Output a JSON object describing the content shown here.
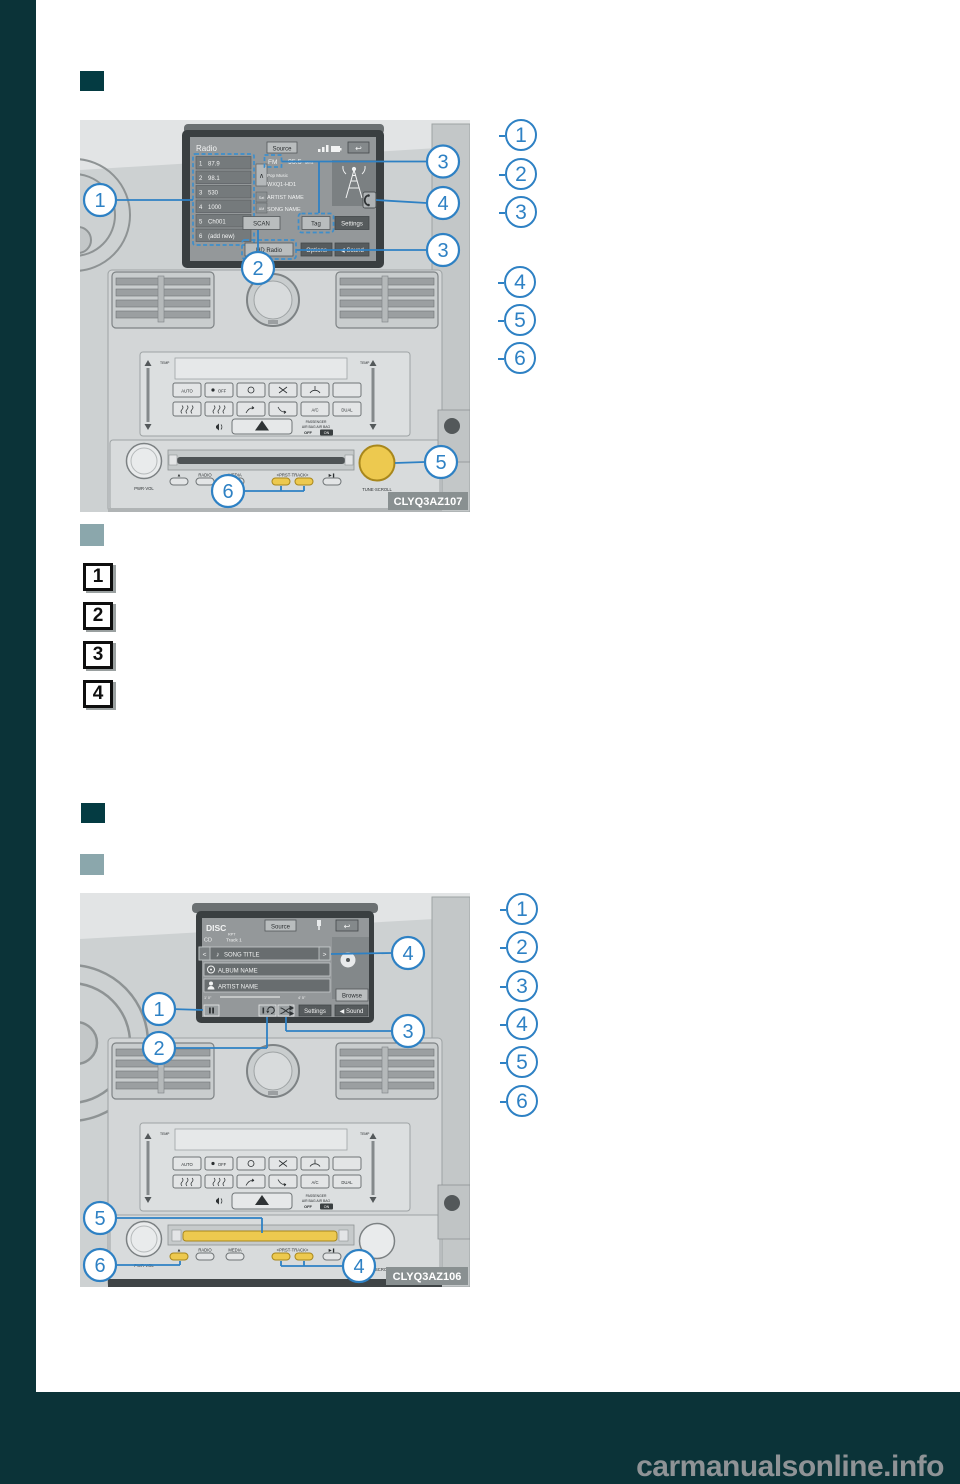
{
  "page": {
    "watermark": "carmanualsonline.info"
  },
  "steps": [
    "1",
    "2",
    "3",
    "4"
  ],
  "legend_radio_a": [
    "1",
    "2",
    "3"
  ],
  "legend_radio_b": [
    "4",
    "5",
    "6"
  ],
  "legend_disc": [
    "1",
    "2",
    "3",
    "4",
    "5",
    "6"
  ],
  "figure_radio": {
    "label": "CLYQ3AZ107",
    "callouts": {
      "c1": "1",
      "c2": "2",
      "c3a": "3",
      "c4": "4",
      "c3b": "3",
      "c5": "5",
      "c6": "6"
    },
    "screen": {
      "title": "Radio",
      "source": "Source",
      "back": "↩",
      "scroll_up": "∧",
      "presets": [
        {
          "num": "1",
          "value": "87.9"
        },
        {
          "num": "2",
          "value": "98.1"
        },
        {
          "num": "3",
          "value": "530"
        },
        {
          "num": "4",
          "value": "1000"
        },
        {
          "num": "5",
          "value": "Ch001"
        },
        {
          "num": "6",
          "value": "(add new)"
        }
      ],
      "tab_sat": "Sat",
      "tab_am": "AM",
      "band": "FM",
      "frequency": "95.5",
      "frequency_unit": "MHz",
      "genre": "Pop Music",
      "station": "WXQ1-HD1",
      "artist": "ARTIST NAME",
      "song": "SONG NAME",
      "scan": "SCAN",
      "tag": "Tag",
      "settings": "Settings",
      "hd_radio": "HD Radio",
      "options": "Options",
      "sound": "◀ Sound"
    }
  },
  "figure_disc": {
    "label": "CLYQ3AZ106",
    "callouts": {
      "c1": "1",
      "c2": "2",
      "c3": "3",
      "c4a": "4",
      "c5": "5",
      "c6": "6",
      "c4b": "4"
    },
    "screen": {
      "title": "DISC",
      "source": "Source",
      "back": "↩",
      "disc_type": "CD",
      "repeat": "RPT",
      "track": "Track 1",
      "prev": "<",
      "next": ">",
      "song_title": "SONG TITLE",
      "album": "ALBUM NAME",
      "artist": "ARTIST NAME",
      "time_elapsed": "1' 0\"",
      "time_total": "4' 5\"",
      "browse": "Browse",
      "settings": "Settings",
      "sound": "◀ Sound"
    }
  },
  "console": {
    "auto": "AUTO",
    "off": "OFF",
    "ac": "A/C",
    "dual": "DUAL",
    "temp": "TEMP",
    "passenger": "PASSENGER",
    "air_bag": "AIR BAG  AIR BAG",
    "airbag_off": "OFF",
    "airbag_on": "ON",
    "pwr_knob": "PWR·VOL",
    "eject": "▲",
    "radio": "RADIO",
    "media": "MEDIA",
    "prst_track": "<PRST·TRACK>",
    "play": "▶❚",
    "tune_knob": "TUNE·SCROLL"
  }
}
